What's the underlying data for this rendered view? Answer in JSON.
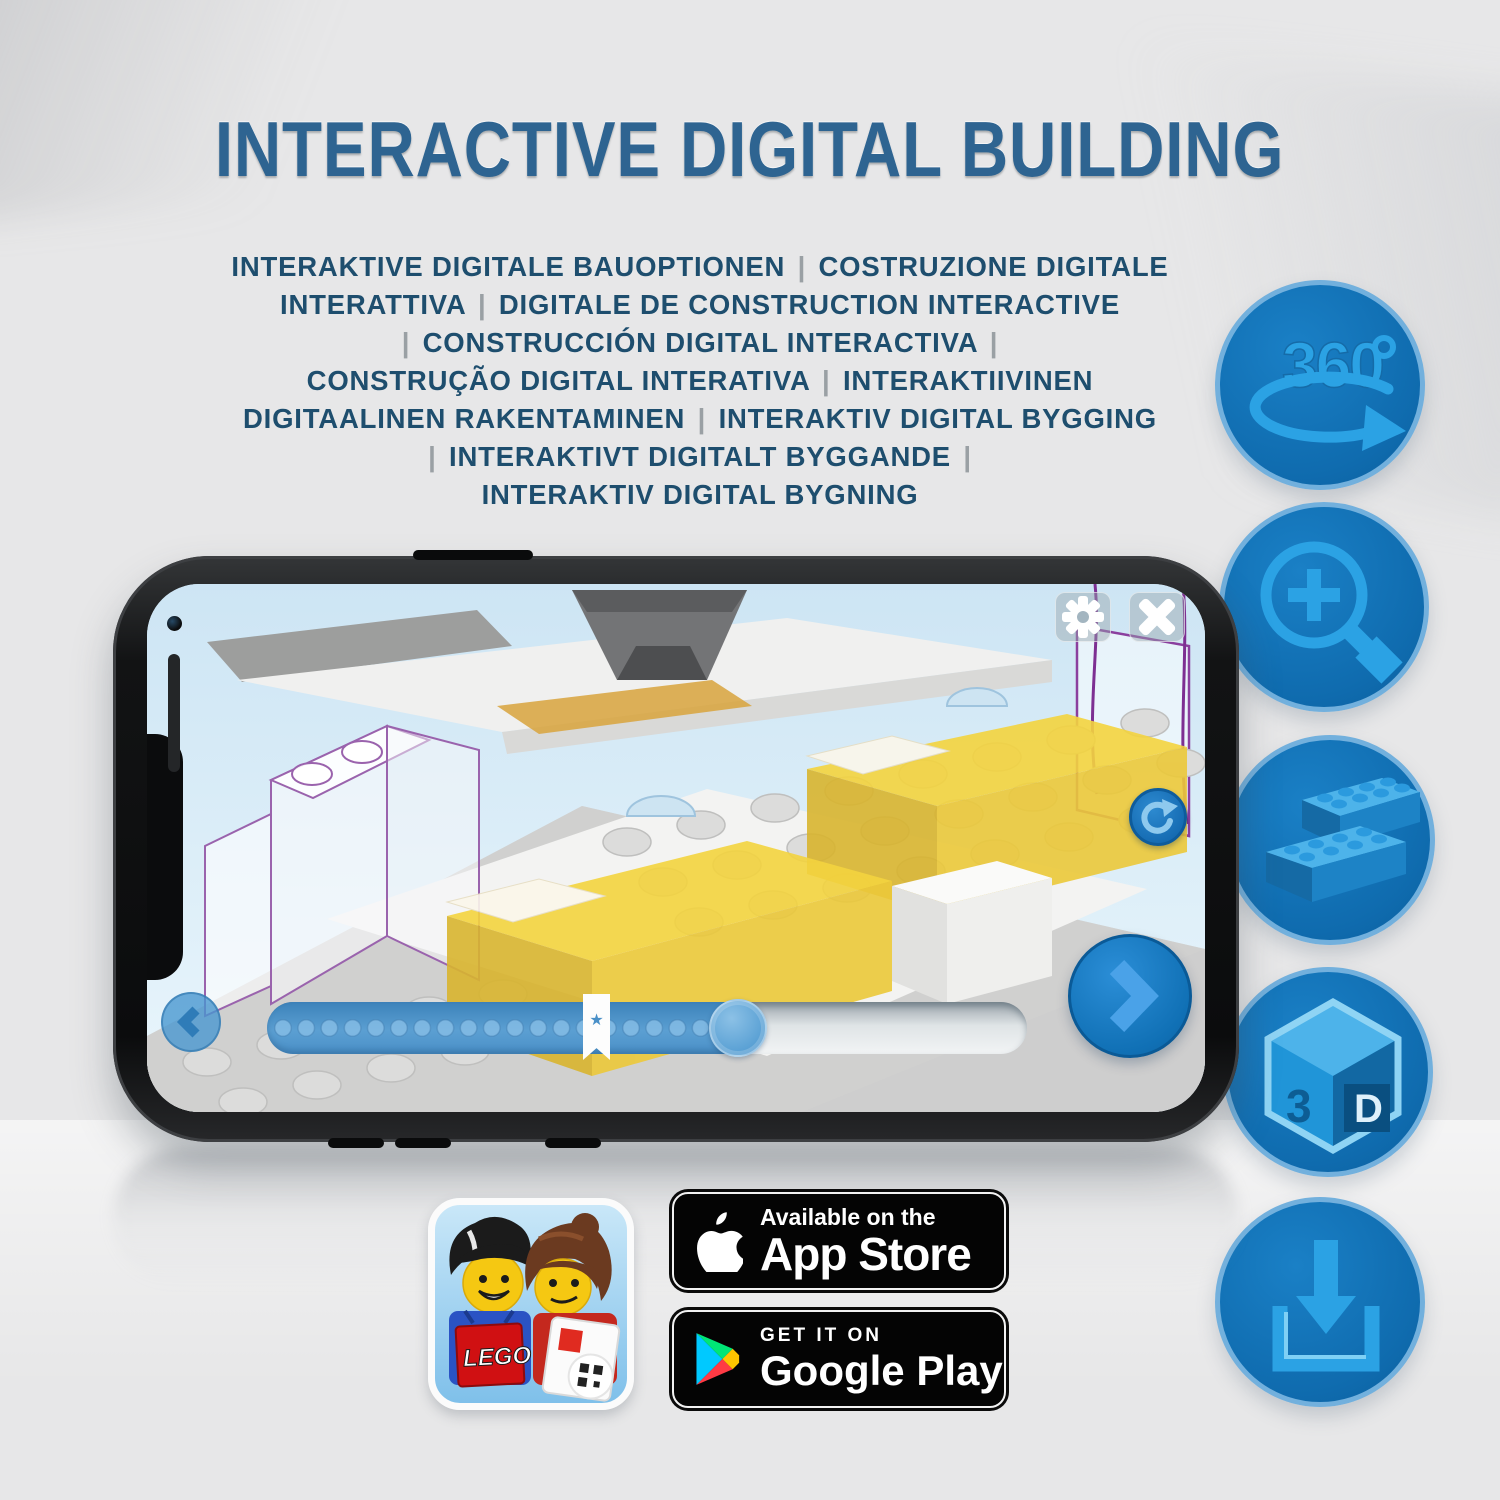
{
  "title": "INTERACTIVE DIGITAL BUILDING",
  "subtitle_lines": [
    "INTERAKTIVE DIGITALE BAUOPTIONEN | COSTRUZIONE DIGITALE",
    "INTERATTIVA | DIGITALE DE CONSTRUCTION INTERACTIVE",
    "| CONSTRUCCIÓN DIGITAL INTERACTIVA |",
    "CONSTRUÇÃO DIGITAL INTERATIVA | INTERAKTIIVINEN",
    "DIGITAALINEN RAKENTAMINEN | INTERAKTIV DIGITAL BYGGING",
    "| INTERAKTIVT DIGITALT BYGGANDE |",
    "INTERAKTIV DIGITAL BYGNING"
  ],
  "features": {
    "rotate_360": {
      "label": "360",
      "degree_symbol": "°"
    },
    "three_d": {
      "left_letter": "3",
      "right_letter": "D"
    }
  },
  "phone_ui": {
    "progress": {
      "dot_count": 20
    }
  },
  "badges": {
    "app_store": {
      "line1": "Available on the",
      "line2": "App Store"
    },
    "google_play": {
      "line1": "GET IT ON",
      "line2": "Google Play"
    }
  },
  "lego_app_icon": {
    "logo_text": "LEGO"
  },
  "colors": {
    "title_blue": "#2e6491",
    "subtitle_blue": "#1e4e6e",
    "circle_blue": "#1173b8",
    "icon_light_blue": "#2ba2e4",
    "bed_yellow": "#f2d23c",
    "badge_black": "#040404"
  }
}
